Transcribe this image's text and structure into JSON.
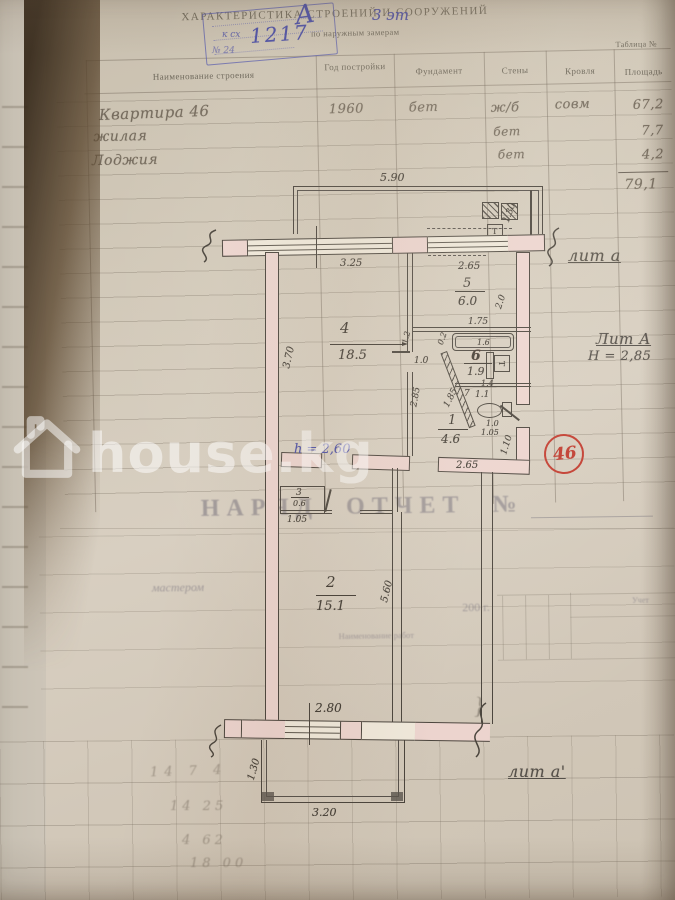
{
  "watermark": {
    "text": "house.kg"
  },
  "form": {
    "title": "ХАРАКТЕРИСТИКА СТРОЕНИЙ И СООРУЖЕНИЙ",
    "subtitle": "по наружным замерам",
    "table_label": "Таблица №",
    "columns": [
      "Наименование строения",
      "Год постройки",
      "Фундамент",
      "Стены",
      "Кровля",
      "Площадь"
    ],
    "rows": [
      {
        "name": "Квартира 46",
        "year": "1960",
        "foundation": "бет",
        "walls": "ж/б",
        "roof": "совм",
        "area": "67,2"
      },
      {
        "name": "жилая",
        "walls": "бет",
        "area": "7,7"
      },
      {
        "name": "Лоджия",
        "walls": "бет",
        "area": "4,2"
      }
    ],
    "total_area": "79,1",
    "report_heading": "НАРЯД ОТЧЕТ №",
    "works_column": "Наименование работ",
    "master_fragment": "мастером",
    "year_fragment": "200 г.",
    "uchet_label": "Учет"
  },
  "stamp": {
    "letter": "А",
    "floors": "3 эт",
    "number": "1217",
    "note": "к сх",
    "note2": "№ 24"
  },
  "plan": {
    "liter_top": "лит а",
    "liter_main": "Лит А",
    "height_main": "Н = 2,85",
    "liter_bottom": "лит а'",
    "height_note": "h = 2,60",
    "badge": "46",
    "t_mark": "Т",
    "t_mark2": "Т",
    "rooms": {
      "r1": {
        "num": "1",
        "area": "4.6"
      },
      "r2": {
        "num": "2",
        "area": "15.1"
      },
      "r3": {
        "num": "3",
        "area": "0.6"
      },
      "r4": {
        "num": "4",
        "area": "18.5"
      },
      "r5": {
        "num": "5",
        "area": "6.0"
      },
      "r6": {
        "num": "6",
        "area": "1.9"
      },
      "r7": {
        "num": "7",
        "area": "1.1"
      }
    },
    "dims": {
      "top_loggia_w": "5.90",
      "room4_w": "3.25",
      "room4_h": "3.70",
      "vent_h": "1.30",
      "room5_w": "2.65",
      "room5_h": "2.0",
      "bath_w": "1.75",
      "tub_len": "1.6",
      "bath_gap": "0.2",
      "door4": "1.0",
      "wallf": "1.2",
      "duct": "1.4",
      "diag": "1.85",
      "hall_wall": "2.85",
      "wc_w": "1.0",
      "wc_w2": "1.05",
      "hall_w": "2.65",
      "hall_h": "1.10",
      "closet_w": "1.05",
      "room2_h": "5.60",
      "room2_w": "2.80",
      "balcony_h": "1.30",
      "balcony_w": "3.20"
    }
  },
  "pencil_notes": {
    "n1": "14 7 4",
    "n2": "14 25",
    "n3": "4 62",
    "n4": "18 00"
  }
}
